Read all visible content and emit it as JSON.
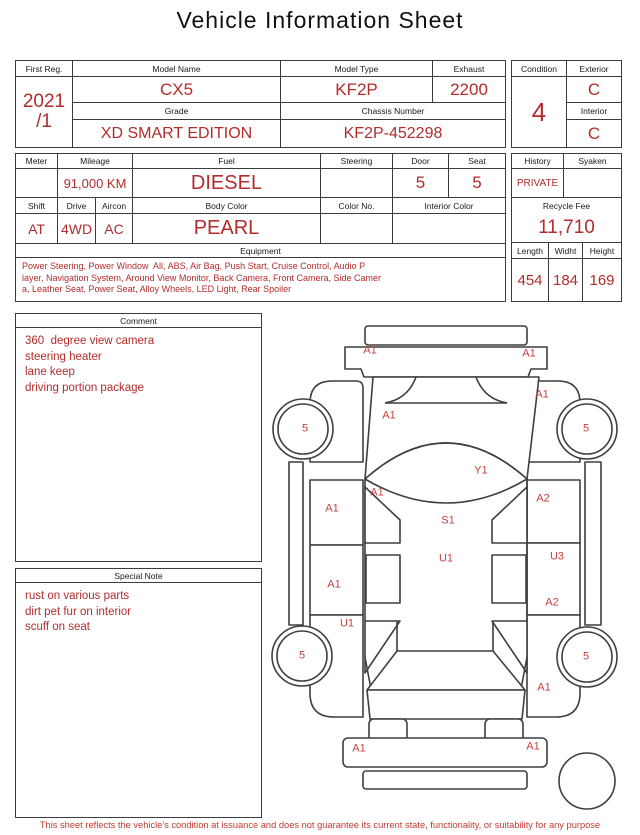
{
  "title": "Vehicle Information Sheet",
  "colors": {
    "text_red": "#b22c2c",
    "marker_red": "#c4403c",
    "line": "#3c3c3c"
  },
  "top": {
    "first_reg": {
      "label": "First Reg.",
      "value_line1": "2021",
      "value_line2": "/1"
    },
    "model_name": {
      "label": "Model Name",
      "value": "CX5"
    },
    "model_type": {
      "label": "Model Type",
      "value": "KF2P"
    },
    "exhaust": {
      "label": "Exhaust",
      "value": "2200"
    },
    "grade": {
      "label": "Grade",
      "value": "XD SMART EDITION"
    },
    "chassis_number": {
      "label": "Chassis Number",
      "value": "KF2P-452298"
    },
    "condition": {
      "label": "Condition",
      "value": "4"
    },
    "exterior": {
      "label": "Exterior",
      "value": "C"
    },
    "interior": {
      "label": "Interior",
      "value": "C"
    }
  },
  "spec": {
    "meter": {
      "label": "Meter",
      "value": ""
    },
    "mileage": {
      "label": "Mileage",
      "value": "91,000 KM"
    },
    "fuel": {
      "label": "Fuel",
      "value": "DIESEL"
    },
    "steering": {
      "label": "Steering",
      "value": ""
    },
    "door": {
      "label": "Door",
      "value": "5"
    },
    "seat": {
      "label": "Seat",
      "value": "5"
    },
    "shift": {
      "label": "Shift",
      "value": "AT"
    },
    "drive": {
      "label": "Drive",
      "value": "4WD"
    },
    "aircon": {
      "label": "Aircon",
      "value": "AC"
    },
    "body_color": {
      "label": "Body Color",
      "value": "PEARL"
    },
    "color_no": {
      "label": "Color No.",
      "value": ""
    },
    "interior_color": {
      "label": "Interior Color",
      "value": ""
    },
    "equipment": {
      "label": "Equipment",
      "lines": [
        "Power Steering, Power Window  All, ABS, Air Bag, Push Start, Cruise Control, Audio P",
        "layer, Navigation System, Around View Monitor, Back Camera, Front Camera, Side Camer",
        "a, Leather Seat, Power Seat, Alloy Wheels, LED Light, Rear Spoiler"
      ]
    }
  },
  "history_box": {
    "history": {
      "label": "History",
      "value": "PRIVATE"
    },
    "syaken": {
      "label": "Syaken",
      "value": ""
    },
    "recycle_fee": {
      "label": "Recycle Fee",
      "value": "11,710"
    },
    "length": {
      "label": "Length",
      "value": "454"
    },
    "width": {
      "label": "Widht",
      "value": "184"
    },
    "height": {
      "label": "Height",
      "value": "169"
    }
  },
  "comment": {
    "label": "Comment",
    "lines": [
      "360  degree view camera",
      "steering heater",
      "lane keep",
      "driving portion package"
    ]
  },
  "special_note": {
    "label": "Special Note",
    "lines": [
      "rust on various parts",
      "dirt pet fur on interior",
      "scuff on seat"
    ]
  },
  "diagram": {
    "markers": [
      {
        "label": "A1",
        "x": 100,
        "y": 36
      },
      {
        "label": "A1",
        "x": 259,
        "y": 39
      },
      {
        "label": "A1",
        "x": 272,
        "y": 80
      },
      {
        "label": "5",
        "x": 35,
        "y": 114
      },
      {
        "label": "5",
        "x": 316,
        "y": 114
      },
      {
        "label": "A1",
        "x": 119,
        "y": 101
      },
      {
        "label": "Y1",
        "x": 211,
        "y": 156
      },
      {
        "label": "A1",
        "x": 107,
        "y": 178
      },
      {
        "label": "A2",
        "x": 273,
        "y": 184
      },
      {
        "label": "A1",
        "x": 62,
        "y": 194
      },
      {
        "label": "S1",
        "x": 178,
        "y": 206
      },
      {
        "label": "U1",
        "x": 176,
        "y": 244
      },
      {
        "label": "U3",
        "x": 287,
        "y": 242
      },
      {
        "label": "A1",
        "x": 64,
        "y": 270
      },
      {
        "label": "A2",
        "x": 282,
        "y": 288
      },
      {
        "label": "U1",
        "x": 77,
        "y": 309
      },
      {
        "label": "5",
        "x": 32,
        "y": 341
      },
      {
        "label": "5",
        "x": 316,
        "y": 342
      },
      {
        "label": "A1",
        "x": 274,
        "y": 373
      },
      {
        "label": "A1",
        "x": 89,
        "y": 434
      },
      {
        "label": "A1",
        "x": 263,
        "y": 432
      }
    ]
  },
  "footer": {
    "disclaimer": "This sheet reflects the vehicle's condition at issuance and does not guarantee its current state, functionality, or suitability for any purpose"
  }
}
